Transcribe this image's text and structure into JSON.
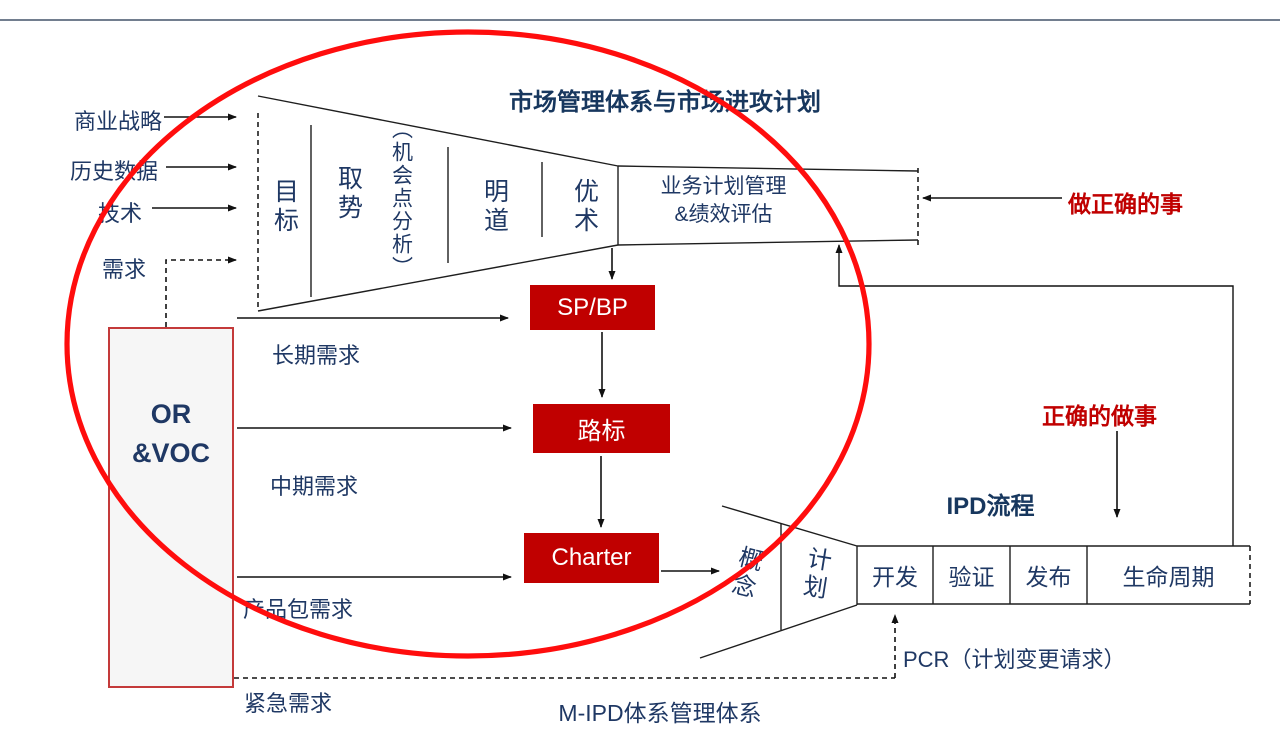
{
  "title": "市场管理体系与市场进攻计划",
  "top_inputs": [
    "商业战略",
    "历史数据",
    "技术",
    "需求"
  ],
  "market_funnel": {
    "columns": [
      "目标",
      "取势",
      "（机会点分析）",
      "明道",
      "优术"
    ],
    "management_line1": "业务计划管理",
    "management_line2": "&绩效评估"
  },
  "plan_chain": {
    "sp_bp": "SP/BP",
    "roadmap": "路标",
    "charter": "Charter"
  },
  "or_voc": {
    "line1": "OR",
    "line2": "&VOC"
  },
  "demand_labels": {
    "long_term": "长期需求",
    "mid_term": "中期需求",
    "product_pkg": "产品包需求",
    "urgent": "紧急需求"
  },
  "ipd": {
    "title": "IPD流程",
    "funnel_stages": [
      "概念",
      "计划"
    ],
    "stages": [
      "开发",
      "验证",
      "发布",
      "生命周期"
    ]
  },
  "annotations": {
    "do_right_things": "做正确的事",
    "do_things_right": "正确的做事",
    "pcr": "PCR（计划变更请求）",
    "m_ipd": "M-IPD体系管理体系"
  },
  "colors": {
    "navy": "#1F3864",
    "box_red": "#C00000",
    "ellipse_red": "#FF0D0D"
  }
}
